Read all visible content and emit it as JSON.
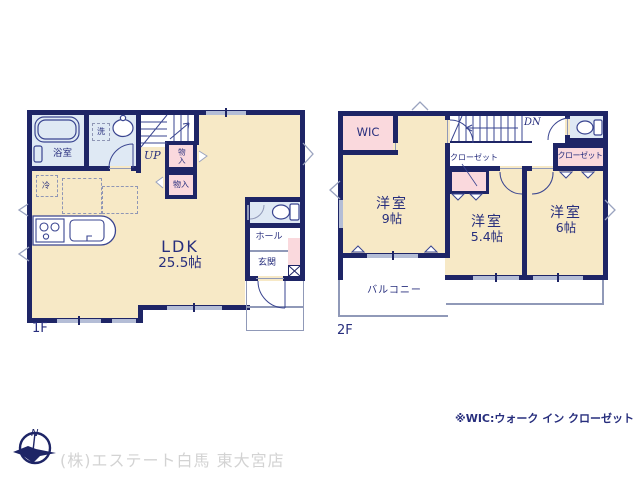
{
  "palette": {
    "wall_navy": "#1e2566",
    "text_navy": "#272e7d",
    "room_cream": "#f7e9c6",
    "closet_pink": "#fad9dd",
    "wet_blue": "#dfe9f4",
    "window_gray": "#b4bdd6",
    "outline_gray": "#9099b8",
    "company_gray": "#d3d3d3"
  },
  "floor1": {
    "label": "1F",
    "rooms": {
      "ldk": {
        "name": "LDK",
        "size": "25.5帖"
      },
      "bath": "浴室",
      "wash": "洗",
      "stairs_up": "UP",
      "storage_upper": "物入",
      "storage_lower": "物入",
      "fridge": "冷",
      "hall": "ホール",
      "entrance": "玄関"
    }
  },
  "floor2": {
    "label": "2F",
    "rooms": {
      "wic": "WIC",
      "stairs_dn": "DN",
      "room9": {
        "name": "洋室",
        "size": "9帖"
      },
      "room54": {
        "name": "洋室",
        "size": "5.4帖"
      },
      "room6": {
        "name": "洋室",
        "size": "6帖"
      },
      "closet_left": "クローゼット",
      "closet_right": "クローゼット",
      "balcony": "バルコニー"
    }
  },
  "footer": {
    "north": "N",
    "company": "(株)エステート白馬 東大宮店",
    "note": "※WIC:ウォーク イン クローゼット"
  }
}
